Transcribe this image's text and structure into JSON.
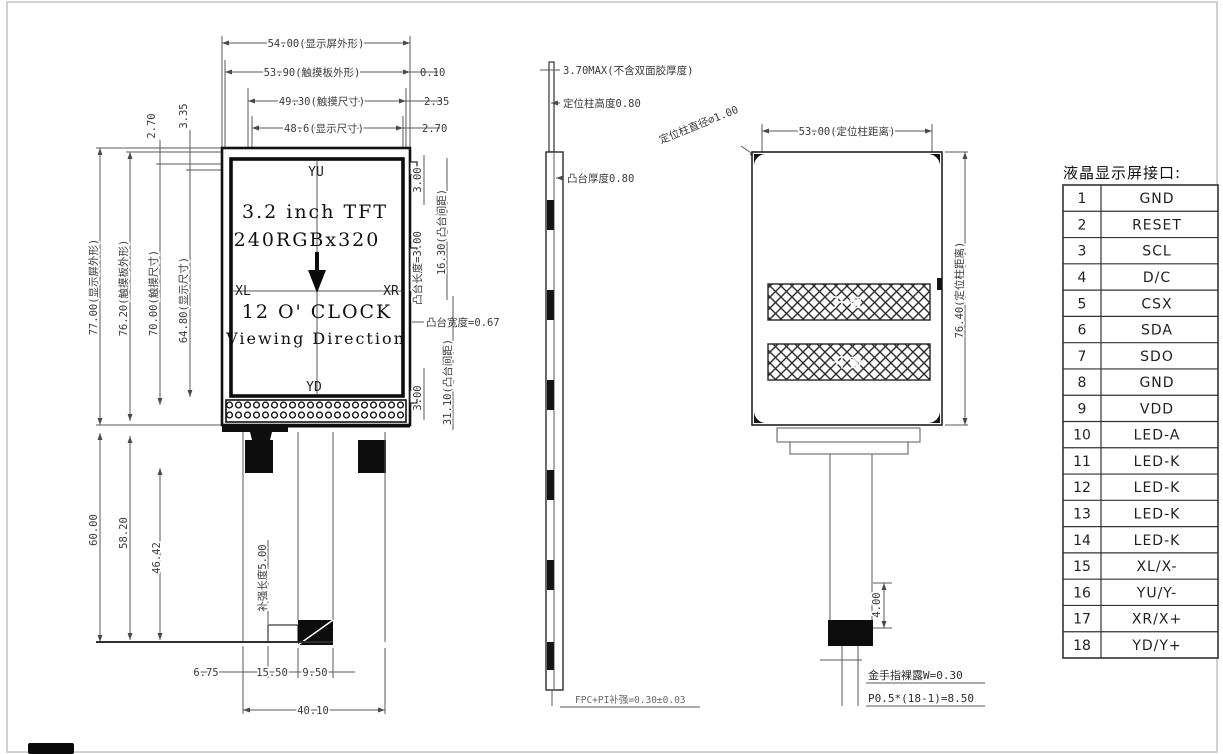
{
  "front_view": {
    "screen": {
      "size_line": "3.2 inch TFT",
      "res_line": "240RGBx320",
      "clock_line": "12 O' CLOCK",
      "viewing_line": "Viewing Direction",
      "dir_top": "YU",
      "dir_bottom": "YD",
      "dir_left": "XL",
      "dir_right": "XR"
    },
    "top_dims": {
      "d1": "54.00(显示屏外形)",
      "d2": "53.90(触摸板外形)",
      "d2_off": "0.10",
      "d3": "49.30(触摸尺寸)",
      "d3_off": "2.35",
      "d4": "48.6(显示尺寸)",
      "d4_off": "2.70"
    },
    "left_dims": {
      "outer": "77.00(显示屏外形)",
      "touch_panel": "76.20(触摸板外形)",
      "touch": "70.00(触摸尺寸)",
      "display": "64.80(显示尺寸)",
      "gap1": "2.70",
      "gap2": "3.35",
      "low1": "60.00",
      "low2": "58.20",
      "low3": "46.42",
      "stiffener": "补强长度5.00"
    },
    "right_dims": {
      "boss_top": "3.00",
      "boss_len": "凸台长度=3.00",
      "boss_gap1": "16.30(凸台间距)",
      "boss_width": "凸台宽度=0.67",
      "boss_bottom": "3.00",
      "boss_gap2": "31.10(凸台间距)"
    },
    "bottom_dims": {
      "d1": "6.75",
      "d2": "15.50",
      "d3": "9.50",
      "d4": "40.10"
    }
  },
  "side_view": {
    "thickness": "3.70MAX(不含双面胶厚度)",
    "post_height": "定位柱高度0.80",
    "boss_thickness": "凸台厚度0.80",
    "fpc": "FPC+PI补强=0.30±0.03"
  },
  "back_view": {
    "post_distance_h": "53.00(定位柱距离)",
    "post_distance_v": "76.40(定位柱距离)",
    "post_diameter": "定位柱直径⌀1.00",
    "window_label": "开窗",
    "tail_height": "4.00",
    "gold_finger": "金手指裸露W=0.30",
    "pitch": "P0.5*(18-1)=8.50"
  },
  "pin_table": {
    "title": "液晶显示屏接口:",
    "rows": [
      {
        "num": "1",
        "name": "GND"
      },
      {
        "num": "2",
        "name": "RESET"
      },
      {
        "num": "3",
        "name": "SCL"
      },
      {
        "num": "4",
        "name": "D/C"
      },
      {
        "num": "5",
        "name": "CSX"
      },
      {
        "num": "6",
        "name": "SDA"
      },
      {
        "num": "7",
        "name": "SDO"
      },
      {
        "num": "8",
        "name": "GND"
      },
      {
        "num": "9",
        "name": "VDD"
      },
      {
        "num": "10",
        "name": "LED-A"
      },
      {
        "num": "11",
        "name": "LED-K"
      },
      {
        "num": "12",
        "name": "LED-K"
      },
      {
        "num": "13",
        "name": "LED-K"
      },
      {
        "num": "14",
        "name": "LED-K"
      },
      {
        "num": "15",
        "name": "XL/X-"
      },
      {
        "num": "16",
        "name": "YU/Y-"
      },
      {
        "num": "17",
        "name": "XR/X+"
      },
      {
        "num": "18",
        "name": "YD/Y+"
      }
    ]
  }
}
